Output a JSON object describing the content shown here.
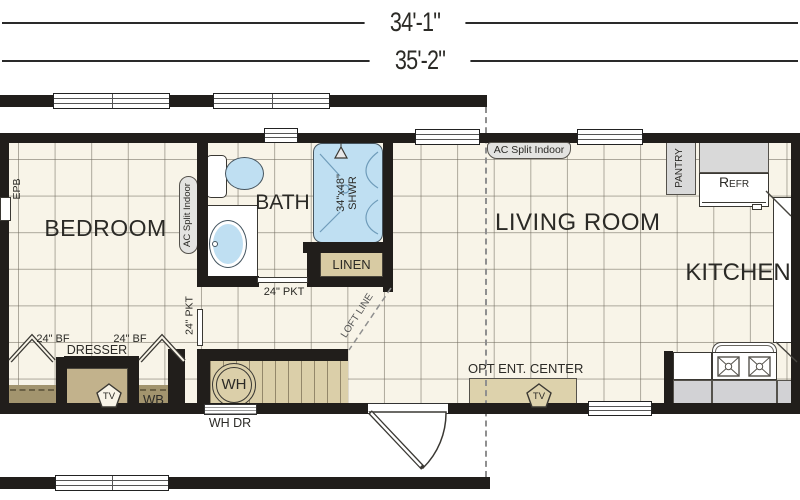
{
  "dimensions": {
    "upper": "34'-1\"",
    "lower": "35'-2\""
  },
  "rooms": {
    "bedroom": "BEDROOM",
    "bath": "BATH",
    "living_room": "LIVING ROOM",
    "kitchen": "KITCHEN"
  },
  "fixtures": {
    "epb": "EPB",
    "ac_split_bedroom": "AC Split Indoor",
    "ac_split_living": "AC Split Indoor",
    "shower_size": "34\"x48\"",
    "shower_abbr": "SHWR",
    "linen": "LINEN",
    "pocket_door_bath": "24\" PKT",
    "pocket_door_bedroom": "24\" PKT",
    "bifold_left": "24\" BF",
    "bifold_right": "24\" BF",
    "dresser": "DRESSER",
    "wardrobe_base": "WB",
    "water_heater": "WH",
    "water_heater_door": "WH DR",
    "loft_line": "LOFT LINE",
    "opt_ent_center": "OPT ENT. CENTER",
    "tv": "TV",
    "pantry": "PANTRY",
    "refrigerator": "Refr"
  },
  "colors": {
    "wall": "#211e1b",
    "floor": "#f8f4e8",
    "fixture_blue": "#bfdff2",
    "cabinet_tan": "#d8cba3",
    "cabinet_tan_dark": "#a2946e",
    "dresser_tan": "#c2b28c",
    "stair_tan": "#dbcfa9",
    "appliance_gray": "#d9d9d9"
  }
}
